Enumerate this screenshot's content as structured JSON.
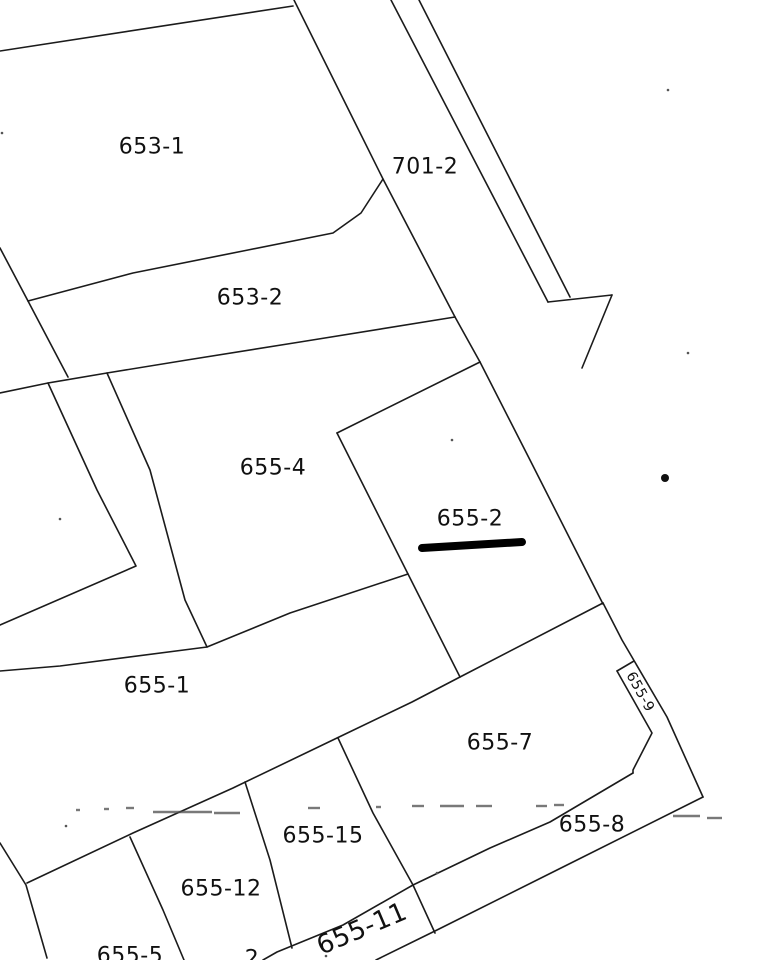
{
  "document": {
    "type": "cadastral-parcel-map-scan",
    "background": "#ffffff",
    "line_color": "#1b1b1b",
    "label_color": "#111111",
    "highlight_color": "#000000"
  },
  "parcels": [
    {
      "id": "653-1",
      "label": "653-1",
      "x": 152,
      "y": 147,
      "rotation": 0,
      "font_size": 22
    },
    {
      "id": "701-2",
      "label": "701-2",
      "x": 425,
      "y": 167,
      "rotation": 0,
      "font_size": 22
    },
    {
      "id": "653-2",
      "label": "653-2",
      "x": 250,
      "y": 298,
      "rotation": 0,
      "font_size": 22
    },
    {
      "id": "655-4",
      "label": "655-4",
      "x": 273,
      "y": 468,
      "rotation": 0,
      "font_size": 22
    },
    {
      "id": "655-2",
      "label": "655-2",
      "x": 470,
      "y": 519,
      "rotation": 0,
      "font_size": 22,
      "highlighted": true
    },
    {
      "id": "655-1",
      "label": "655-1",
      "x": 157,
      "y": 686,
      "rotation": 0,
      "font_size": 22
    },
    {
      "id": "655-7",
      "label": "655-7",
      "x": 500,
      "y": 743,
      "rotation": 0,
      "font_size": 22
    },
    {
      "id": "655-9",
      "label": "655-9",
      "x": 640,
      "y": 692,
      "rotation": 61,
      "font_size": 14
    },
    {
      "id": "655-8",
      "label": "655-8",
      "x": 592,
      "y": 825,
      "rotation": 0,
      "font_size": 22
    },
    {
      "id": "655-15",
      "label": "655-15",
      "x": 323,
      "y": 836,
      "rotation": 0,
      "font_size": 22
    },
    {
      "id": "655-12",
      "label": "655-12",
      "x": 221,
      "y": 889,
      "rotation": 0,
      "font_size": 22
    },
    {
      "id": "655-11",
      "label": "655-11",
      "x": 362,
      "y": 929,
      "rotation": -23,
      "font_size": 26
    },
    {
      "id": "655-5",
      "label": "655-5",
      "x": 130,
      "y": 956,
      "rotation": 0,
      "font_size": 22
    },
    {
      "id": "cut-off",
      "label": "2",
      "x": 252,
      "y": 959,
      "rotation": 0,
      "font_size": 22
    }
  ],
  "boundaries": [
    {
      "name": "653-1-top-edge",
      "points": [
        [
          0,
          51
        ],
        [
          293,
          6
        ]
      ]
    },
    {
      "name": "653-group-east-edge",
      "points": [
        [
          294,
          0
        ],
        [
          383,
          179
        ],
        [
          455,
          317
        ]
      ]
    },
    {
      "name": "653-west-steep-edge",
      "points": [
        [
          0,
          248
        ],
        [
          28,
          301
        ],
        [
          68,
          377
        ]
      ]
    },
    {
      "name": "653-1-south-edge",
      "points": [
        [
          28,
          301
        ],
        [
          133,
          273
        ],
        [
          248,
          250
        ],
        [
          333,
          233
        ],
        [
          361,
          213
        ],
        [
          383,
          179
        ]
      ]
    },
    {
      "name": "653-2-south-edge",
      "points": [
        [
          0,
          393
        ],
        [
          48,
          383
        ],
        [
          107,
          373
        ],
        [
          187,
          360
        ],
        [
          300,
          342
        ],
        [
          455,
          317
        ]
      ]
    },
    {
      "name": "lane-west-line",
      "points": [
        [
          48,
          383
        ],
        [
          97,
          490
        ],
        [
          136,
          566
        ],
        [
          0,
          625
        ]
      ]
    },
    {
      "name": "lane-east-line",
      "points": [
        [
          107,
          373
        ],
        [
          150,
          470
        ],
        [
          185,
          600
        ],
        [
          207,
          647
        ],
        [
          60,
          666
        ],
        [
          0,
          671
        ]
      ]
    },
    {
      "name": "655-4-south-edge",
      "points": [
        [
          207,
          647
        ],
        [
          290,
          613
        ],
        [
          408,
          574
        ]
      ]
    },
    {
      "name": "655-2-west-edge",
      "points": [
        [
          337,
          433
        ],
        [
          408,
          574
        ],
        [
          460,
          677
        ]
      ]
    },
    {
      "name": "655-2-northwest-edge",
      "points": [
        [
          480,
          362
        ],
        [
          337,
          433
        ]
      ]
    },
    {
      "name": "655-2-north-spur",
      "points": [
        [
          455,
          317
        ],
        [
          480,
          362
        ]
      ]
    },
    {
      "name": "655-2-east-edge",
      "points": [
        [
          480,
          362
        ],
        [
          530,
          460
        ],
        [
          603,
          604
        ]
      ]
    },
    {
      "name": "main-diagonal-edge",
      "points": [
        [
          27,
          883
        ],
        [
          133,
          833
        ],
        [
          233,
          788
        ],
        [
          337,
          738
        ],
        [
          412,
          702
        ],
        [
          460,
          677
        ],
        [
          603,
          603
        ]
      ]
    },
    {
      "name": "east-boundary-edge",
      "points": [
        [
          603,
          603
        ],
        [
          622,
          640
        ],
        [
          667,
          717
        ],
        [
          703,
          797
        ]
      ]
    },
    {
      "name": "southeast-diagonal",
      "points": [
        [
          703,
          797
        ],
        [
          563,
          867
        ],
        [
          437,
          930
        ],
        [
          376,
          960
        ]
      ]
    },
    {
      "name": "band-north-edge",
      "points": [
        [
          263,
          960
        ],
        [
          277,
          952
        ],
        [
          343,
          925
        ],
        [
          413,
          885
        ],
        [
          490,
          848
        ],
        [
          550,
          822
        ],
        [
          633,
          773
        ]
      ]
    },
    {
      "name": "655-5-west-edge",
      "points": [
        [
          0,
          843
        ],
        [
          26,
          885
        ],
        [
          47,
          958
        ]
      ]
    },
    {
      "name": "655-5-east-edge",
      "points": [
        [
          130,
          837
        ],
        [
          163,
          910
        ],
        [
          184,
          960
        ]
      ]
    },
    {
      "name": "655-12-east-edge",
      "points": [
        [
          245,
          782
        ],
        [
          270,
          860
        ],
        [
          292,
          948
        ]
      ]
    },
    {
      "name": "655-15-east-edge",
      "points": [
        [
          338,
          738
        ],
        [
          373,
          813
        ],
        [
          413,
          885
        ],
        [
          435,
          933
        ]
      ]
    },
    {
      "name": "655-9-cap-edge",
      "points": [
        [
          617,
          671
        ],
        [
          634,
          661
        ]
      ]
    },
    {
      "name": "655-9-inner-edge",
      "points": [
        [
          617,
          671
        ],
        [
          652,
          733
        ],
        [
          633,
          770
        ],
        [
          633,
          773
        ]
      ]
    },
    {
      "name": "road-west-line",
      "points": [
        [
          391,
          0
        ],
        [
          548,
          302
        ]
      ]
    },
    {
      "name": "road-east-line",
      "points": [
        [
          419,
          0
        ],
        [
          570,
          297
        ]
      ]
    },
    {
      "name": "road-end-cross-line",
      "points": [
        [
          548,
          302
        ],
        [
          612,
          295
        ]
      ]
    },
    {
      "name": "road-arrow-line",
      "points": [
        [
          612,
          295
        ],
        [
          582,
          368
        ]
      ]
    }
  ],
  "highlight_bar": {
    "x1": 422,
    "y1": 548,
    "x2": 522,
    "y2": 542,
    "width": 8,
    "color": "#000000"
  },
  "survey_dot": {
    "x": 665,
    "y": 478,
    "r": 4,
    "color": "#111111"
  },
  "scan_artifacts": {
    "dash_color": "#4d4d4d",
    "dashes": [
      [
        76,
        80,
        810
      ],
      [
        104,
        109,
        809
      ],
      [
        126,
        134,
        808
      ],
      [
        153,
        212,
        812
      ],
      [
        214,
        240,
        813
      ],
      [
        308,
        320,
        808
      ],
      [
        376,
        381,
        807
      ],
      [
        412,
        424,
        806
      ],
      [
        440,
        464,
        806
      ],
      [
        476,
        492,
        806
      ],
      [
        536,
        547,
        806
      ],
      [
        554,
        564,
        805
      ],
      [
        673,
        700,
        816
      ],
      [
        707,
        722,
        818
      ]
    ],
    "specks": [
      [
        668,
        90
      ],
      [
        688,
        353
      ],
      [
        452,
        440
      ],
      [
        60,
        519
      ],
      [
        66,
        826
      ],
      [
        437,
        873
      ],
      [
        326,
        956
      ],
      [
        2,
        133
      ]
    ]
  }
}
